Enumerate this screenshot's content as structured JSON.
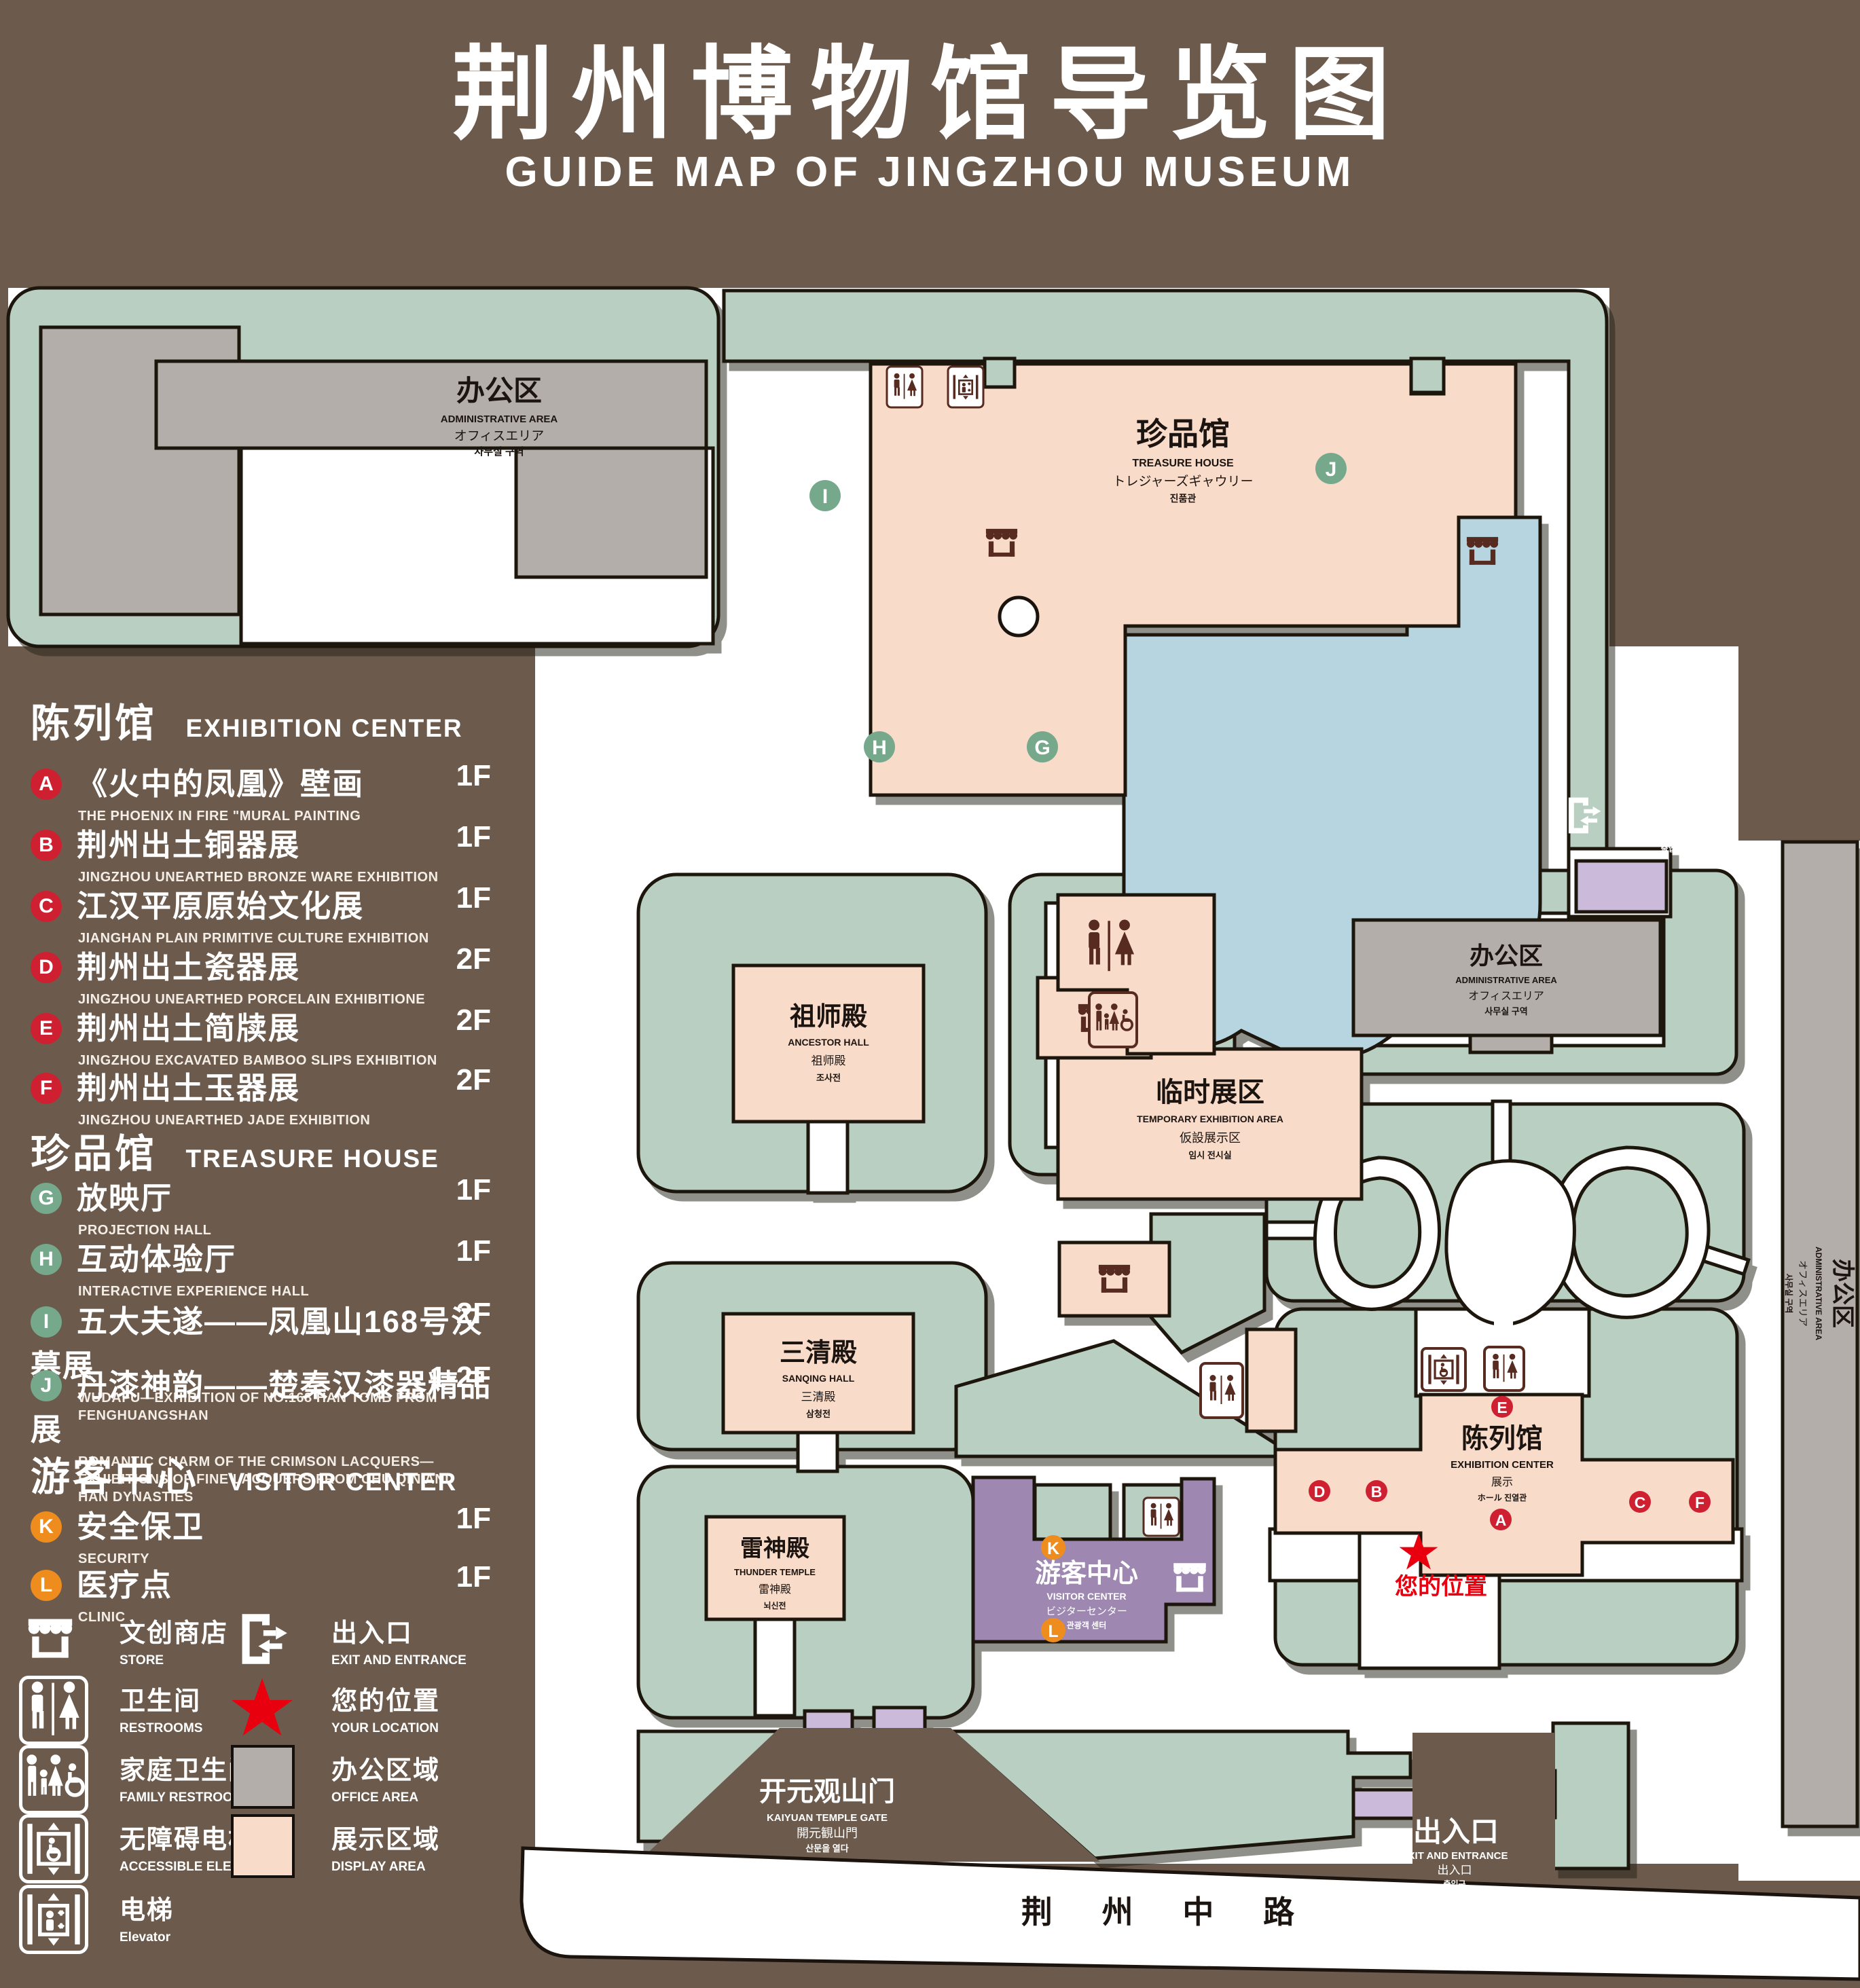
{
  "title": {
    "cn": "荆州博物馆导览图",
    "en": "GUIDE MAP OF JINGZHOU MUSEUM"
  },
  "legend": {
    "sections": [
      {
        "id": "exhibition_center",
        "title_cn": "陈列馆",
        "title_en": "EXHIBITION CENTER",
        "items": [
          {
            "id": "A",
            "cn": "《火中的凤凰》壁画",
            "en": "THE PHOENIX IN FIRE \"MURAL PAINTING",
            "floor": "1F"
          },
          {
            "id": "B",
            "cn": "荆州出土铜器展",
            "en": "JINGZHOU UNEARTHED BRONZE WARE EXHIBITION",
            "floor": "1F"
          },
          {
            "id": "C",
            "cn": "江汉平原原始文化展",
            "en": "JIANGHAN PLAIN PRIMITIVE CULTURE EXHIBITION",
            "floor": "1F"
          },
          {
            "id": "D",
            "cn": "荆州出土瓷器展",
            "en": "JINGZHOU UNEARTHED PORCELAIN EXHIBITIONE",
            "floor": "2F"
          },
          {
            "id": "E",
            "cn": "荆州出土简牍展",
            "en": "JINGZHOU EXCAVATED BAMBOO SLIPS EXHIBITION",
            "floor": "2F"
          },
          {
            "id": "F",
            "cn": "荆州出土玉器展",
            "en": "JINGZHOU UNEARTHED JADE EXHIBITION",
            "floor": "2F"
          }
        ]
      },
      {
        "id": "treasure_house",
        "title_cn": "珍品馆",
        "title_en": "TREASURE HOUSE",
        "items": [
          {
            "id": "G",
            "cn": "放映厅",
            "en": "PROJECTION HALL",
            "floor": "1F"
          },
          {
            "id": "H",
            "cn": "互动体验厅",
            "en": "INTERACTIVE EXPERIENCE HALL",
            "floor": "1F"
          },
          {
            "id": "I",
            "cn": "五大夫遂——凤凰山168号汉墓展",
            "en": "WUDAFU—EXHIBITION OF NO.168 HAN TOMB FROM FENGHUANGSHAN",
            "floor": "2F"
          },
          {
            "id": "J",
            "cn": "丹漆神韵——楚秦汉漆器精品展",
            "en": "ROMANTIC CHARM OF THE CRIMSON LACQUERS—EXHIBITIONS OF FINE LACQUERS FROM CHU,QIN AND HAN DYNASTIES",
            "floor": "1-2F"
          }
        ]
      },
      {
        "id": "visitor_center",
        "title_cn": "游客中心",
        "title_en": "VISITOR CENTER",
        "items": [
          {
            "id": "K",
            "cn": "安全保卫",
            "en": "SECURITY",
            "floor": "1F"
          },
          {
            "id": "L",
            "cn": "医疗点",
            "en": "CLINIC",
            "floor": "1F"
          }
        ]
      }
    ],
    "symbols_left": [
      {
        "icon": "store-icon",
        "cn": "文创商店",
        "en": "STORE"
      },
      {
        "icon": "restrooms-icon",
        "cn": "卫生间",
        "en": "RESTROOMS"
      },
      {
        "icon": "family-restrooms-icon",
        "cn": "家庭卫生间",
        "en": "FAMILY RESTROOMS"
      },
      {
        "icon": "accessible-elevator-icon",
        "cn": "无障碍电梯",
        "en": "ACCESSIBLE ELEVATOR"
      },
      {
        "icon": "elevator-icon",
        "cn": "电梯",
        "en": "Elevator"
      }
    ],
    "symbols_right": [
      {
        "icon": "exit-icon",
        "cn": "出入口",
        "en": "EXIT AND ENTRANCE"
      },
      {
        "icon": "location-star-icon",
        "cn": "您的位置",
        "en": "YOUR LOCATION"
      },
      {
        "icon": "office-area-swatch",
        "cn": "办公区域",
        "en": "OFFICE AREA"
      },
      {
        "icon": "display-area-swatch",
        "cn": "展示区域",
        "en": "DISPLAY AREA"
      }
    ]
  },
  "map": {
    "admin_area": {
      "cn": "办公区",
      "en": "ADMINISTRATIVE AREA",
      "jp": "オフィスエリア",
      "kr": "사무실 구역"
    },
    "treasure_house": {
      "cn": "珍品馆",
      "en": "TREASURE HOUSE",
      "jp": "トレジャーズギャウリー",
      "kr": "진품관"
    },
    "ancestor_hall": {
      "cn": "祖师殿",
      "en": "ANCESTOR HALL",
      "jp": "祖师殿",
      "kr": "조사전"
    },
    "sanqing_hall": {
      "cn": "三清殿",
      "en": "SANQING HALL",
      "jp": "三清殿",
      "kr": "삼청전"
    },
    "thunder_temple": {
      "cn": "雷神殿",
      "en": "THUNDER TEMPLE",
      "jp": "雷神殿",
      "kr": "뇌신전"
    },
    "temporary_area": {
      "cn": "临时展区",
      "en": "TEMPORARY EXHIBITION AREA",
      "jp": "仮設展示区",
      "kr": "임시 전시실"
    },
    "exhibition_center": {
      "cn": "陈列馆",
      "en": "EXHIBITION CENTER",
      "jp": "展示",
      "kr": "ホール 진열관"
    },
    "visitor_center": {
      "cn": "游客中心",
      "en": "VISITOR CENTER",
      "jp": "ビジターセンター",
      "kr": "관광객 센터"
    },
    "kaiyuan_gate": {
      "cn": "开元观山门",
      "en": "KAIYUAN TEMPLE GATE",
      "jp": "開元観山門",
      "kr": "산문을 열다"
    },
    "exit": {
      "cn": "出入口",
      "en": "EXIT AND ENTRANCE",
      "jp": "出入口",
      "kr": "출입구"
    },
    "your_location": "您的位置",
    "road": "荆 州 中 路",
    "markers": {
      "A": "A",
      "B": "B",
      "C": "C",
      "D": "D",
      "E": "E",
      "F": "F",
      "G": "G",
      "H": "H",
      "I": "I",
      "J": "J",
      "K": "K",
      "L": "L"
    }
  },
  "colors": {
    "background": "#6c5b4d",
    "park_green": "#b9cfc2",
    "display_area": "#f8dbc8",
    "office_area": "#b4aeab",
    "water": "#b7d5e0",
    "visitor_center": "#9e88b2",
    "gate_purple": "#cbbad9",
    "marker_red": "#ce2030",
    "marker_green": "#76a98c",
    "marker_orange": "#ee8d1d",
    "icon_brown": "#572b20",
    "location_red": "#e8000f"
  }
}
